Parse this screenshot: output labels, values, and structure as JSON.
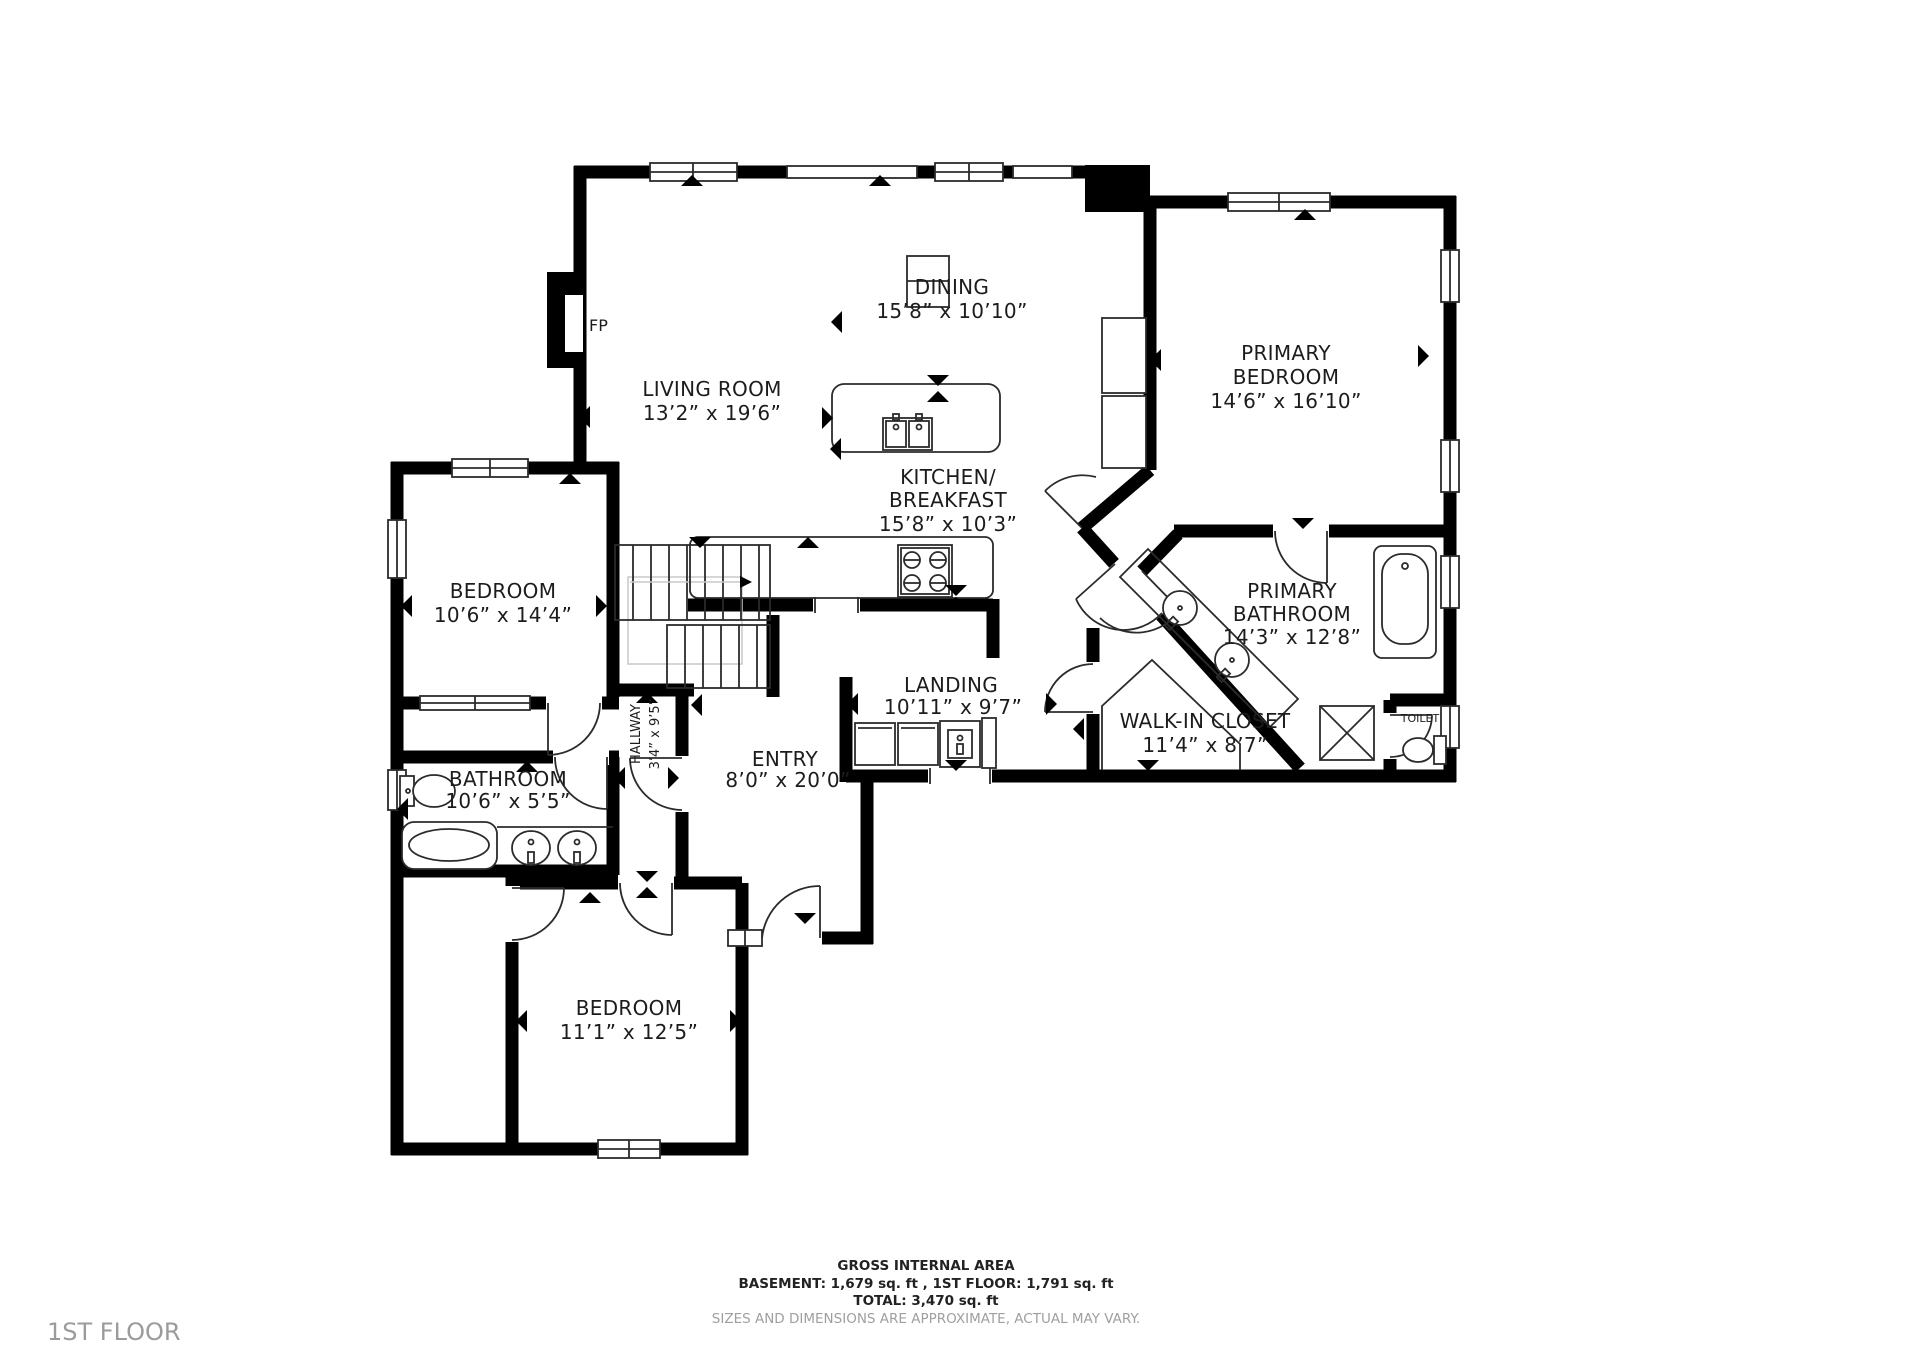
{
  "floor_label": "1ST FLOOR",
  "rooms": {
    "living": {
      "label": "LIVING ROOM",
      "dims": "13’2” x 19’6”"
    },
    "dining": {
      "label": "DINING",
      "dims": "15’8” x 10’10”"
    },
    "kitchen": {
      "label": "KITCHEN/",
      "label2": "BREAKFAST",
      "dims": "15’8” x 10’3”"
    },
    "primary_bedroom": {
      "label": "PRIMARY",
      "label2": "BEDROOM",
      "dims": "14’6” x 16’10”"
    },
    "primary_bathroom": {
      "label": "PRIMARY",
      "label2": "BATHROOM",
      "dims": "14’3” x 12’8”"
    },
    "bedroom_left": {
      "label": "BEDROOM",
      "dims": "10’6” x 14’4”"
    },
    "landing": {
      "label": "LANDING",
      "dims": "10’11” x 9’7”"
    },
    "walk_in_closet": {
      "label": "WALK-IN CLOSET",
      "dims": "11’4” x 8’7”"
    },
    "hallway": {
      "label": "HALLWAY",
      "dims": "3’4” x 9’5”"
    },
    "bathroom": {
      "label": "BATHROOM",
      "dims": "10’6” x 5’5”"
    },
    "entry": {
      "label": "ENTRY",
      "dims": "8’0” x 20’0”"
    },
    "bedroom_bottom": {
      "label": "BEDROOM",
      "dims": "11’1” x 12’5”"
    },
    "toilet": {
      "label": "TOILET"
    },
    "fireplace": {
      "label": "FP"
    }
  },
  "footer": {
    "gross": "GROSS INTERNAL AREA",
    "areas": "BASEMENT: 1,679 sq. ft , 1ST FLOOR: 1,791 sq. ft",
    "total": "TOTAL: 3,470 sq. ft",
    "disclaimer": "SIZES AND DIMENSIONS ARE APPROXIMATE, ACTUAL MAY VARY."
  }
}
